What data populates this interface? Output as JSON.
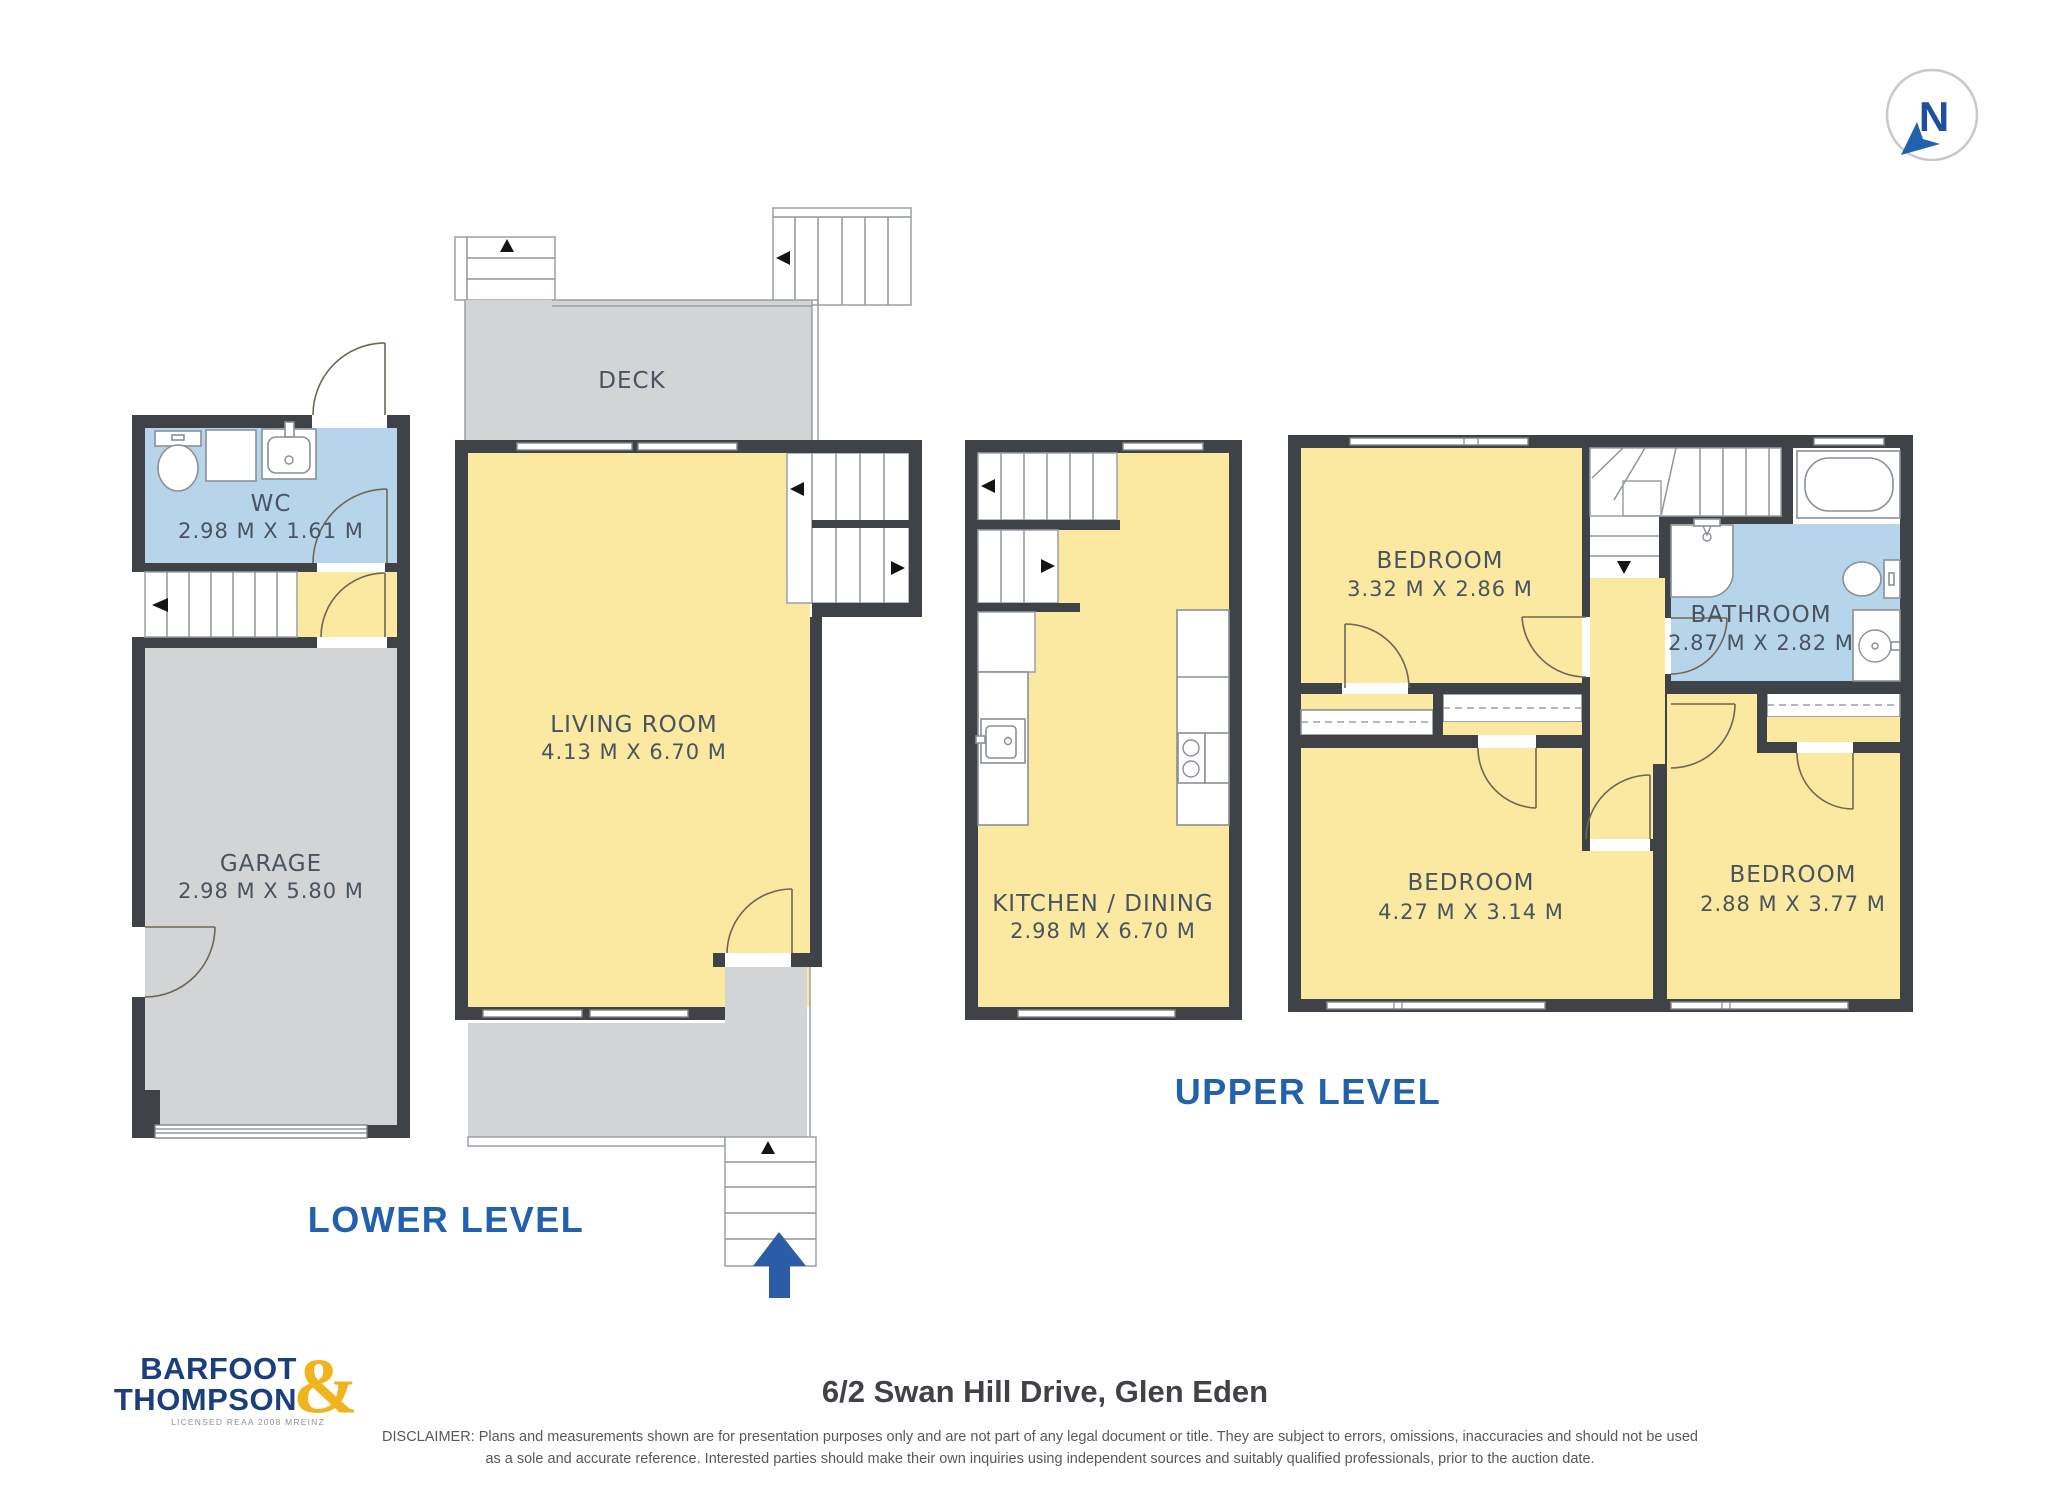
{
  "compass": {
    "letter": "N"
  },
  "plans": {
    "lower": {
      "label": "LOWER LEVEL",
      "wc": {
        "name": "WC",
        "dims": "2.98 M X 1.61 M"
      },
      "garage": {
        "name": "GARAGE",
        "dims": "2.98 M X 5.80 M"
      },
      "deck": {
        "name": "DECK"
      },
      "living": {
        "name": "LIVING ROOM",
        "dims": "4.13 M X 6.70 M"
      },
      "kitchen": {
        "name": "KITCHEN / DINING",
        "dims": "2.98 M X 6.70 M"
      }
    },
    "upper": {
      "label": "UPPER LEVEL",
      "bedroom1": {
        "name": "BEDROOM",
        "dims": "3.32 M X 2.86 M"
      },
      "bathroom": {
        "name": "BATHROOM",
        "dims": "2.87 M X 2.82 M"
      },
      "bedroom2": {
        "name": "BEDROOM",
        "dims": "4.27 M X 3.14 M"
      },
      "bedroom3": {
        "name": "BEDROOM",
        "dims": "2.88 M X 3.77 M"
      }
    }
  },
  "footer": {
    "address": "6/2 Swan Hill Drive, Glen Eden",
    "disclaimer_line1": "DISCLAIMER: Plans and measurements shown are for presentation purposes only and are not part of any legal document or title. They are subject to errors, omissions, inaccuracies and should not be used",
    "disclaimer_line2": "as a sole and accurate reference. Interested parties should make their own inquiries using independent sources and suitably qualified professionals, prior to the auction date."
  },
  "logo": {
    "line1": "BARFOOT",
    "line2": "THOMPSON",
    "ampersand": "&",
    "tagline": "LICENSED REAA 2008 MREINZ"
  },
  "colors": {
    "wall": "#3F4347",
    "room_yellow": "#FBE9A2",
    "room_blue": "#B7D5EA",
    "floor_gray": "#D2D4D6",
    "accent_blue": "#2161AE",
    "logo_navy": "#1B3E7C",
    "logo_yellow": "#F0B41C"
  }
}
